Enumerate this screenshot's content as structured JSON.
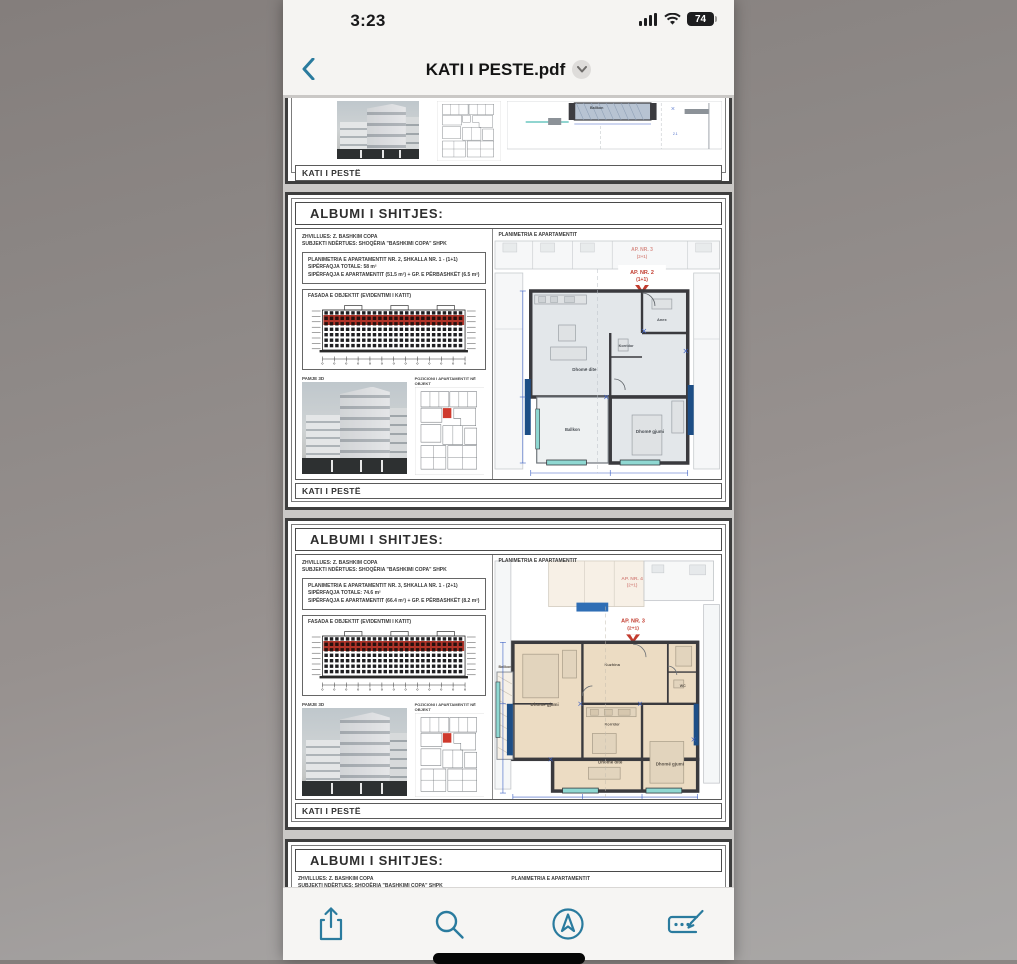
{
  "status_bar": {
    "time": "3:23",
    "battery_percent": "74"
  },
  "nav_bar": {
    "title": "KATI I PESTE.pdf"
  },
  "colors": {
    "accent_teal": "#2a7b9e",
    "highlight_red": "#b8342a",
    "dim_blue": "#3b5fc4",
    "shaft_blue": "#1d4e86",
    "window_teal": "#8fd8d2",
    "plan_gray_fill": "#e3e7ea",
    "plan_beige_fill": "#ecdcc3"
  },
  "pdf": {
    "header": "ALBUMI I SHITJES:",
    "footer_label": "KATI I PESTË",
    "plan_caption": "PLANIMETRIA E APARTAMENTIT",
    "developer_line1": "ZHVILLUES: Z. BASHKIM COPA",
    "developer_line2": "SUBJEKTI NDËRTUES: SHOQËRIA \"BASHKIMI COPA\" SHPK",
    "facade_label": "FASADA E OBJEKTIT (EVIDENTIMI I KATIT)",
    "photo_caption": "PAMJE 3D",
    "keyplan_caption": "POZICIONI I APARTAMENTIT NË OBJEKT",
    "page2": {
      "info_line1": "PLANIMETRIA E APARTAMENTIT NR. 2, SHKALLA NR. 1 - (1+1)",
      "info_line2": "SIPËRFAQJA TOTALE: 58 m²",
      "info_line3": "SIPËRFAQJA E APARTAMENTIT (51.5 m²) + GP. E PËRBASHKËT (6.5 m²)",
      "ap_adjacent": "AP. NR. 3",
      "ap_adjacent_type": "(2+1)",
      "ap_main": "AP. NR. 2",
      "ap_main_type": "(1+1)",
      "entry_label": "HYRJA",
      "rooms": {
        "living": "Dhomë dite",
        "annex": "Anex",
        "bedroom": "Dhomë gjumi",
        "corridor": "Korridor",
        "balcony": "Ballkon"
      }
    },
    "page3": {
      "info_line1": "PLANIMETRIA E APARTAMENTIT NR. 3, SHKALLA NR. 1 - (2+1)",
      "info_line2": "SIPËRFAQJA TOTALE: 74.6 m²",
      "info_line3": "SIPËRFAQJA E APARTAMENTIT (66.4 m²) + GP. E PËRBASHKËT (8.2 m²)",
      "ap_adjacent": "AP. NR. 4",
      "ap_adjacent_type": "(2+1)",
      "ap_main": "AP. NR. 3",
      "ap_main_type": "(2+1)",
      "entry_label": "HYRJA",
      "rooms": {
        "bedroom1": "Dhomë gjumi",
        "kitchen": "Kuzhina",
        "corridor": "Korridor",
        "living": "Dhomë dite",
        "bedroom2": "Dhomë gjumi",
        "balcony": "Ballkon",
        "wc": "WC"
      }
    }
  },
  "toolbar": {
    "icons": [
      "share",
      "search",
      "navigate",
      "markup"
    ]
  }
}
